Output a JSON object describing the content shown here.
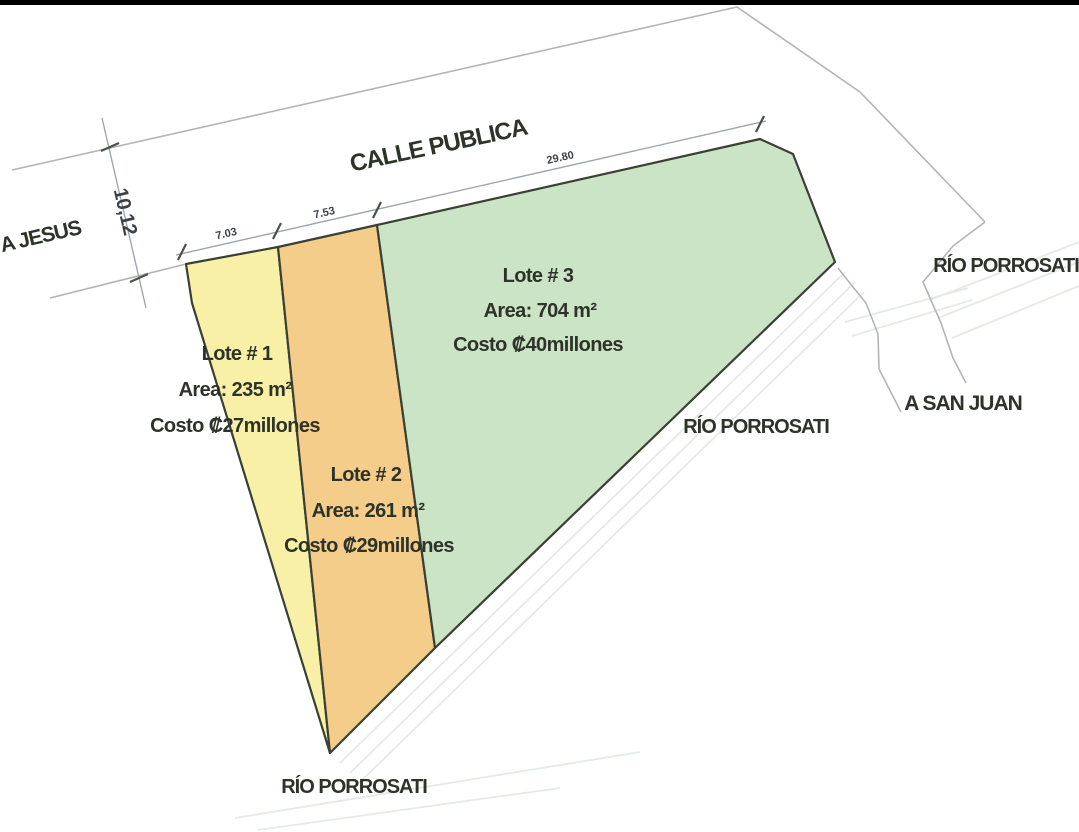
{
  "drawing": {
    "street_label": "CALLE PUBLICA",
    "road_left_label": "A JESUS",
    "road_right_label": "A SAN JUAN",
    "river_label_right": "RÍO PORROSATI",
    "river_label_middle": "RÍO PORROSATI",
    "river_label_bottom": "RÍO PORROSATI"
  },
  "dimensions": {
    "street_width": "10,12",
    "lot1_frontage": "7.03",
    "lot2_frontage": "7.53",
    "lot3_frontage": "29.80"
  },
  "lots": [
    {
      "name": "Lote # 1",
      "area": "Area: 235 m²",
      "cost": "Costo ₡27millones",
      "fill": "#f7f0a6"
    },
    {
      "name": "Lote # 2",
      "area": "Area: 261 m²",
      "cost": "Costo ₡29millones",
      "fill": "#f4cd8b"
    },
    {
      "name": "Lote # 3",
      "area": "Area: 704 m²",
      "cost": "Costo ₡40millones",
      "fill": "#cce4c6"
    }
  ],
  "colors": {
    "lot_outline": "#3a4034",
    "boundary_line": "#b4b4b4",
    "dimension_line": "#9aa1a9",
    "tick": "#4c5046",
    "text": "#2e3329",
    "dim_text": "#3c4147",
    "river_line": "#dde3dd",
    "top_bar": "#000000",
    "background": "#ffffff"
  }
}
